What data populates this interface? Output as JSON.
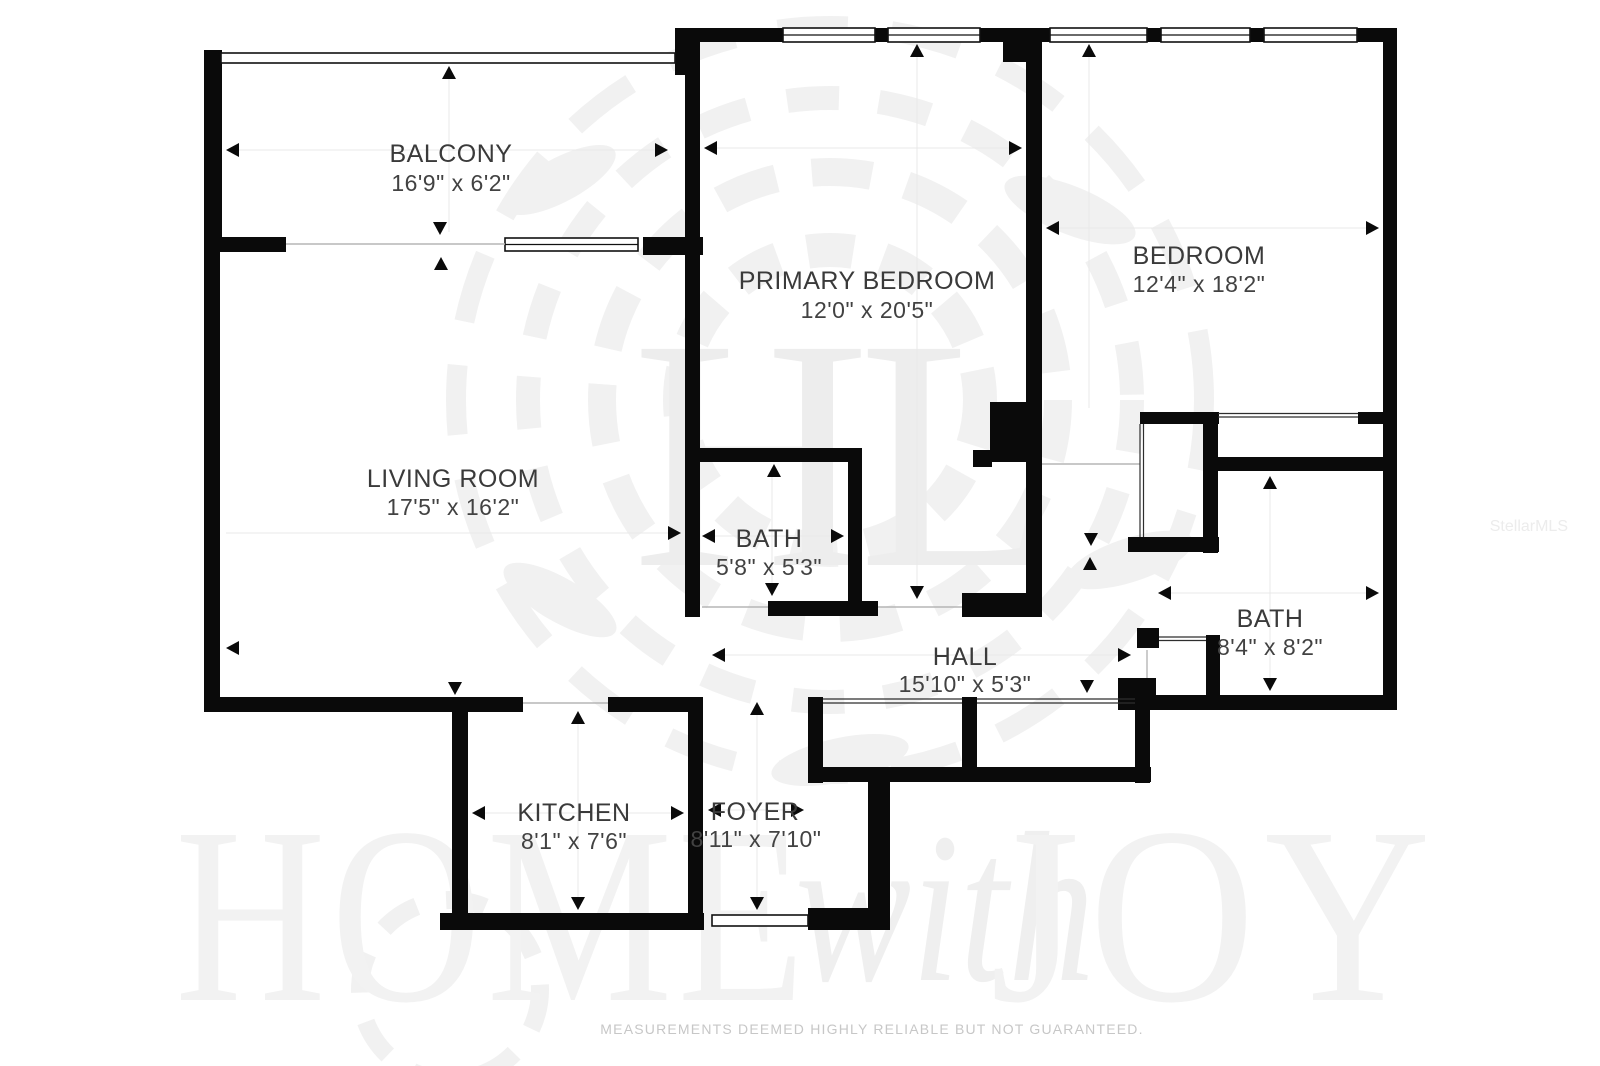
{
  "rooms": [
    {
      "name": "BALCONY",
      "dims": "16'9\" x 6'2\""
    },
    {
      "name": "PRIMARY BEDROOM",
      "dims": "12'0\" x 20'5\""
    },
    {
      "name": "BEDROOM",
      "dims": "12'4\" x 18'2\""
    },
    {
      "name": "LIVING ROOM",
      "dims": "17'5\" x 16'2\""
    },
    {
      "name": "BATH",
      "dims": "5'8\" x 5'3\""
    },
    {
      "name": "HALL",
      "dims": "15'10\" x 5'3\""
    },
    {
      "name": "BATH",
      "dims": "8'4\" x 8'2\""
    },
    {
      "name": "KITCHEN",
      "dims": "8'1\" x 7'6\""
    },
    {
      "name": "FOYER",
      "dims": "8'11\" x 7'10\""
    }
  ],
  "watermarks": {
    "brand_word1": "HOME",
    "brand_script": "with",
    "brand_word2": "JOY",
    "logo_monogram": "HL",
    "mls": "StellarMLS"
  },
  "footer": {
    "disclaimer": "MEASUREMENTS DEEMED HIGHLY RELIABLE BUT NOT GUARANTEED."
  },
  "colors": {
    "wall": "#0a0a0a",
    "label": "#3a3a3a",
    "watermark": "#f1f1f1",
    "disclaimer": "#c7c7c7"
  }
}
